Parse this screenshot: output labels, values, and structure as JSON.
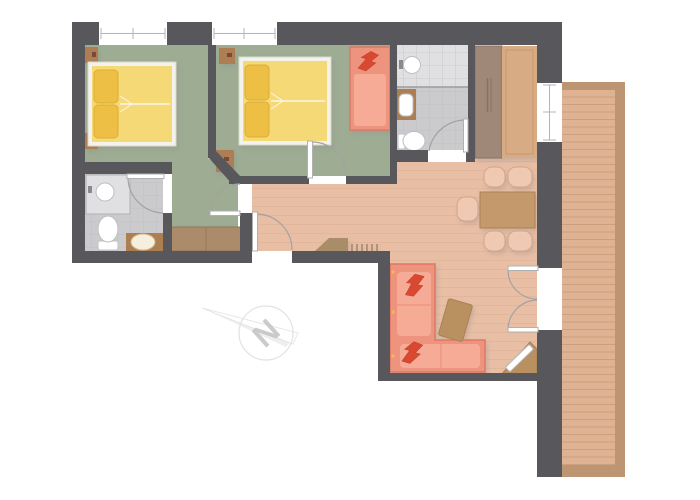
{
  "title": "apartment-floor-plan",
  "compass": {
    "label": "N"
  },
  "legend": {
    "rooms": [
      "bedroom-1",
      "bedroom-2",
      "bathroom-1",
      "bathroom-2",
      "hall-living-dining",
      "balcony"
    ],
    "furniture": [
      "double-bed-1",
      "double-bed-2",
      "daybed-couch",
      "l-shaped-sofa",
      "coffee-table",
      "tv-corner",
      "dining-table",
      "dining-chairs",
      "wardrobe-bedroom-1",
      "tall-wardrobe",
      "entrance-bench",
      "toilet",
      "shower",
      "washbasin"
    ]
  },
  "colors": {
    "wall": "#57575c",
    "white": "#ffffff",
    "floorWood": "#e8bea5",
    "woodLine": "#dcae92",
    "floorGreen": "#9dac92",
    "tile": "#cbcbce",
    "tileLight": "#e0e0e3",
    "tileLine": "#bcbcc0",
    "deck": "#dfb293",
    "deckLine": "#cc9f7e",
    "deckFrame": "#bd9573",
    "bedFrame": "#f4f2ec",
    "bedFrameStroke": "#dcd8cd",
    "mattress": "#f6d977",
    "pillow": "#edc044",
    "pillowStroke": "#ddad32",
    "woodDark": "#ad7e52",
    "wardrobe": "#ab8b6b",
    "wardrobeStroke": "#93775a",
    "sofa": "#ee937e",
    "sofaDark": "#dd7963",
    "sofaLight": "#f6ab97",
    "sofaPillow": "#d94a32",
    "sofaPillowStroke": "#c23c28",
    "chair": "#efc9b2",
    "chairStroke": "#d6a488",
    "tableWood": "#c49a6c",
    "tableStroke": "#ac8157",
    "tvWood": "#b9905f",
    "fixtureStroke": "#bfbfc3",
    "fixtureHandle": "#8a8a8e",
    "sinkBasin": "#f6efdd",
    "sinkBasinStroke": "#cfba90",
    "doorArc": "#a2a2a2",
    "leafStroke": "#b0b0b0",
    "windowLine": "#b4b4b4",
    "wardrobeTallDark": "#a08878",
    "wardrobeTallDarkStroke": "#897263",
    "wardrobeTallLight": "#d7ab83",
    "wardrobeTallLightLine": "#c79a72",
    "benchWood": "#a88e68",
    "tickStroke": "#8f7a5e",
    "showerLine": "#9c9ca0",
    "dividerLine": "#94785c",
    "lampDark": "#7a4a35",
    "creaseWhite": "#fbf6e8",
    "compassLine": "#e2e2e2",
    "compassFill": "#ececec",
    "compassText": "#c6c6c6"
  }
}
